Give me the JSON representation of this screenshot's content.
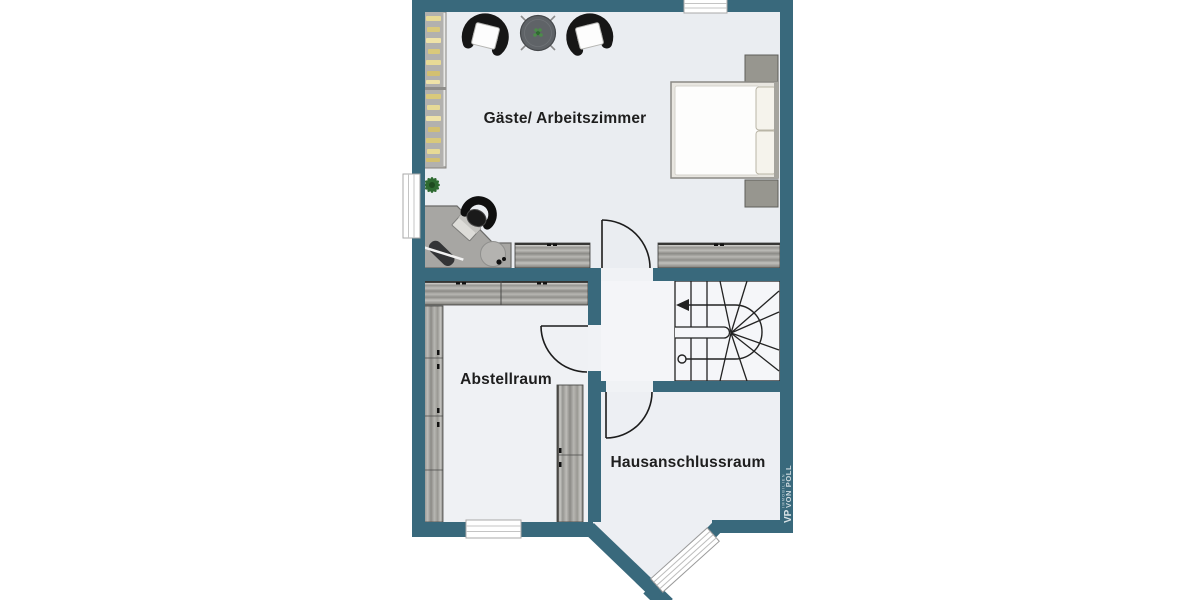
{
  "colors": {
    "wall": "#39697c",
    "floor_base": "#f0f2f5",
    "floor_guest": "#eaedf1",
    "floor_hall": "#f4f5f8",
    "line": "#1c1c1c",
    "text": "#1e1e1e",
    "watermark": "#cfdbe0"
  },
  "rooms": [
    {
      "name": "Gäste/ Arbeitszimmer"
    },
    {
      "name": "Abstellraum"
    },
    {
      "name": "Hausanschlussraum"
    }
  ],
  "watermark": {
    "monogram": "VP",
    "brand": "VON POLL",
    "division": "IMMOBILIEN"
  },
  "furniture": [
    "bookshelf",
    "armchair-left",
    "round-table",
    "plant-on-table",
    "armchair-right",
    "double-bed",
    "nightstand-top",
    "nightstand-bottom",
    "floor-plant",
    "corner-desk",
    "office-chair",
    "laptop",
    "desk-lamp",
    "stool",
    "sideboard-left",
    "sideboard-right",
    "wardrobe",
    "tall-cabinet-left",
    "tall-cabinet-right",
    "winder-staircase"
  ]
}
